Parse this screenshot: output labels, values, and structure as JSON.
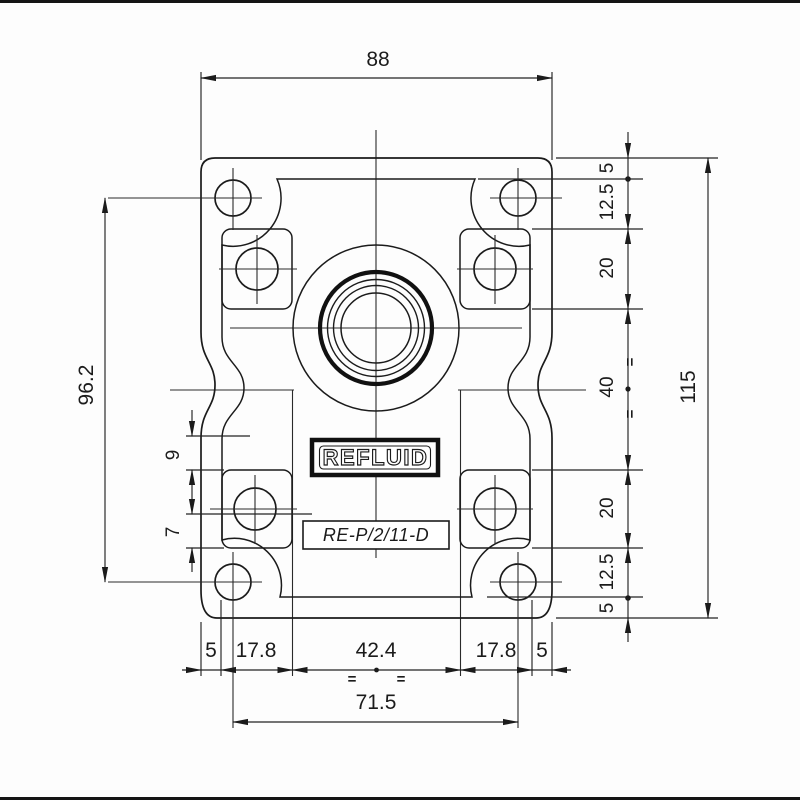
{
  "drawing": {
    "brand": "REFLUID",
    "model": "RE-P/2/11-D",
    "symmetry_mark": "=",
    "dims": {
      "top": "88",
      "overall_height": "115",
      "hole_spacing_v": "96.2",
      "hole_spacing_h": "71.5",
      "left_a": "9",
      "left_b": "7",
      "right": [
        "5",
        "12.5",
        "20",
        "40",
        "20",
        "12.5",
        "5"
      ],
      "bottom": [
        "5",
        "17.8",
        "42.4",
        "17.8",
        "5"
      ]
    }
  }
}
